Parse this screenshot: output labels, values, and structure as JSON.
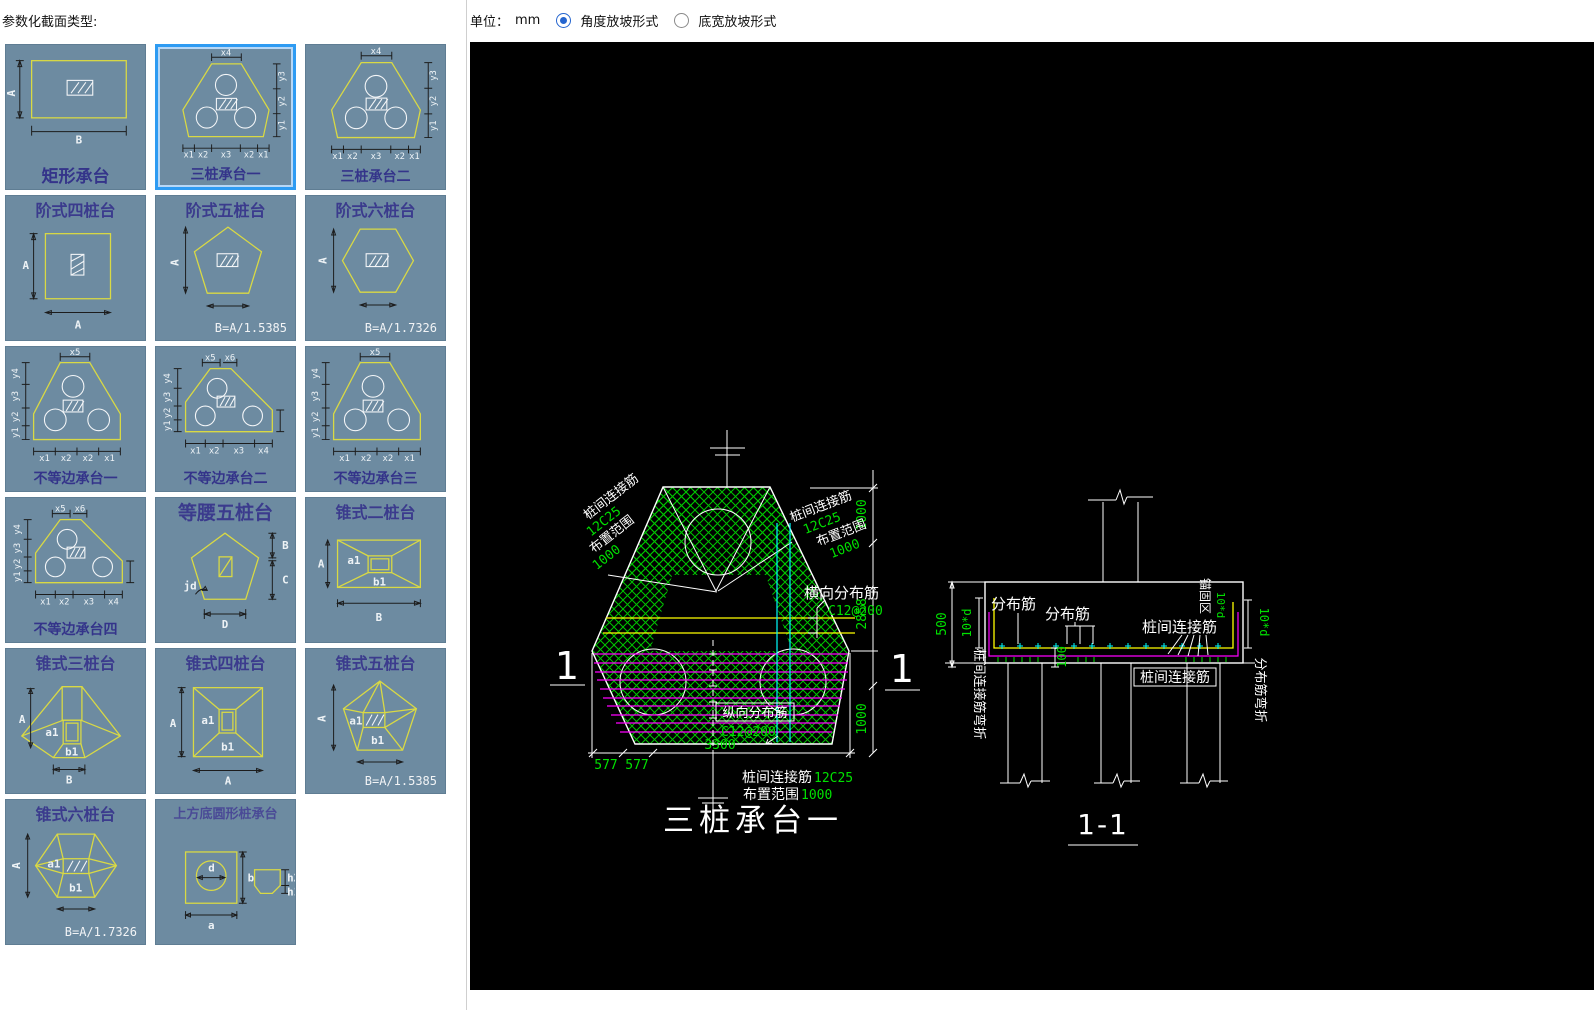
{
  "header": {
    "panel_title": "参数化截面类型:",
    "unit_label": "单位：",
    "unit_value": "mm",
    "radios": [
      {
        "label": "角度放坡形式",
        "selected": true
      },
      {
        "label": "底宽放坡形式",
        "selected": false
      }
    ]
  },
  "colors": {
    "accent_blue": "#2e9bf2",
    "cad_green": "#00e000",
    "cad_yellow": "#ffff00",
    "cad_magenta": "#ff00ff",
    "cad_cyan": "#00ffff",
    "tile_bg": "#6d8ba1"
  },
  "sidebar": {
    "tiles": [
      {
        "label": "矩形承台",
        "dims": [
          "A",
          "B"
        ],
        "selected": false
      },
      {
        "label": "三桩承台一",
        "dims": [
          "x4",
          "y3",
          "y2",
          "y1",
          "x1",
          "x2",
          "x3"
        ],
        "selected": true
      },
      {
        "label": "三桩承台二",
        "dims": [
          "x4",
          "y3",
          "y2",
          "y1",
          "x1",
          "x2",
          "x3"
        ],
        "selected": false
      },
      {
        "label": "阶式四桩台",
        "dims": [
          "A",
          "A"
        ],
        "selected": false
      },
      {
        "label": "阶式五桩台",
        "dims": [
          "A"
        ],
        "formula": "B=A/1.5385",
        "selected": false
      },
      {
        "label": "阶式六桩台",
        "dims": [
          "A"
        ],
        "formula": "B=A/1.7326",
        "selected": false
      },
      {
        "label": "不等边承台一",
        "dims": [
          "x5",
          "y4",
          "y3",
          "y2",
          "y1",
          "x1",
          "x2"
        ],
        "selected": false
      },
      {
        "label": "不等边承台二",
        "dims": [
          "x5",
          "x6",
          "y4",
          "y3",
          "y2",
          "y1",
          "x1",
          "x2",
          "x3",
          "x4"
        ],
        "selected": false
      },
      {
        "label": "不等边承台三",
        "dims": [
          "x5",
          "y4",
          "y3",
          "y2",
          "y1",
          "x1",
          "x2"
        ],
        "selected": false
      },
      {
        "label": "不等边承台四",
        "dims": [
          "x5",
          "x6",
          "y4",
          "y3",
          "y2",
          "y1",
          "x1",
          "x2",
          "x3",
          "x4"
        ],
        "selected": false
      },
      {
        "label": "等腰五桩台",
        "dims": [
          "jd",
          "B",
          "C",
          "D"
        ],
        "selected": false
      },
      {
        "label": "锥式二桩台",
        "dims": [
          "A",
          "a1",
          "b1",
          "B"
        ],
        "selected": false
      },
      {
        "label": "锥式三桩台",
        "dims": [
          "A",
          "a1",
          "b1",
          "B"
        ],
        "selected": false
      },
      {
        "label": "锥式四桩台",
        "dims": [
          "A",
          "a1",
          "b1",
          "A"
        ],
        "selected": false
      },
      {
        "label": "锥式五桩台",
        "dims": [
          "A",
          "a1",
          "b1"
        ],
        "formula": "B=A/1.5385",
        "selected": false
      },
      {
        "label": "锥式六桩台",
        "dims": [
          "A",
          "a1",
          "b1"
        ],
        "formula": "B=A/1.7326",
        "selected": false
      },
      {
        "label": "上方底圆形桩承台",
        "dims": [
          "d",
          "b",
          "a",
          "h2",
          "h1"
        ],
        "selected": false
      }
    ]
  },
  "canvas": {
    "plan": {
      "title": "三桩承台一",
      "section_mark_left": "1",
      "section_mark_right": "1",
      "label_left": {
        "l1": "桩间连接筋",
        "l2": "12C25",
        "l3": "布置范围",
        "l4": "1000"
      },
      "label_right": {
        "l1": "桩间连接筋",
        "l2": "12C25",
        "l3": "布置范围",
        "l4": "1000"
      },
      "transverse": {
        "name": "横向分布筋",
        "spec": "C12@200"
      },
      "longitudinal": {
        "name": "纵向分布筋",
        "spec": "C12@200"
      },
      "bottom_note1": {
        "name": "桩间连接筋",
        "spec": "12C25"
      },
      "bottom_note2": {
        "name": "布置范围",
        "spec": "1000"
      },
      "dim_right_top": "1000",
      "dim_right_mid": "2858",
      "dim_right_bottom": "1000",
      "dim_bottom_total": "3300",
      "dim_bottom_a": "577",
      "dim_bottom_b": "577"
    },
    "section": {
      "title": "1-1",
      "dist1": "分布筋",
      "dist2": "分布筋",
      "pile_conn_inner": "桩间连接筋",
      "pile_conn_boxed": "桩间连接筋",
      "anchor_zone": "锚固区",
      "anchor_dim": "10*d",
      "dim_500": "500",
      "dim_10d_left": "10*d",
      "dim_10d_right": "10*d",
      "dim_100": "100",
      "left_rotated": "桩间连接筋弯折",
      "right_rotated": "分布筋弯折"
    }
  }
}
